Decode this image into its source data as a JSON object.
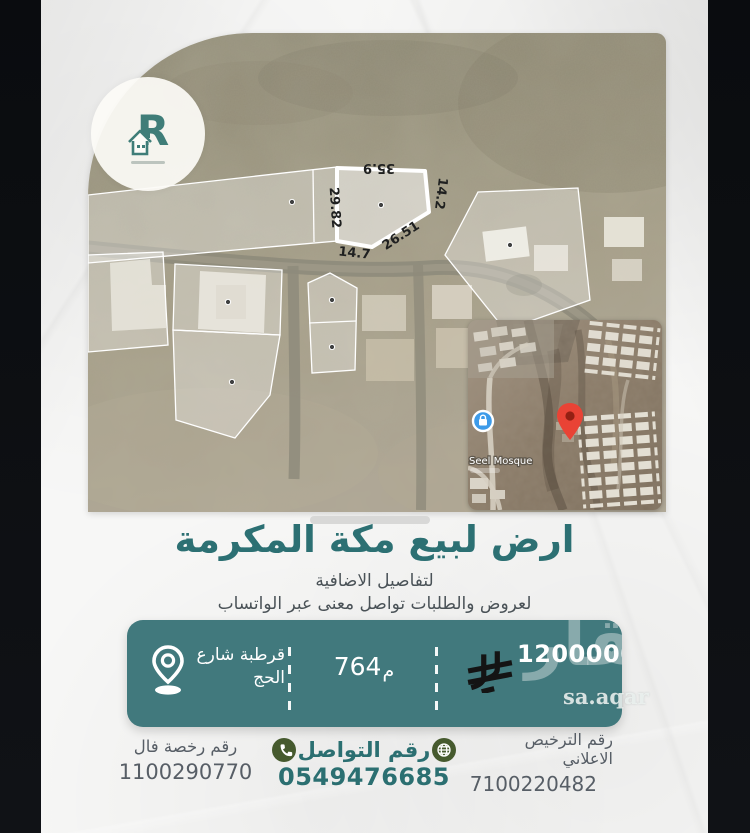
{
  "logo": {
    "letter": "R"
  },
  "map": {
    "measurements": {
      "top": "35.9",
      "right": "14.2",
      "left": "29.82",
      "diagonal": "26.51",
      "bottom": "14.7"
    }
  },
  "inset": {
    "mosque_label": "Seel Mosque"
  },
  "headline": {
    "title": "ارض لبيع مكة المكرمة",
    "details_line": "لتفاصيل الاضافية",
    "whatsapp_line": "لعروض والطلبات تواصل معنى عبر الواتساب"
  },
  "banner": {
    "price": "1200000",
    "area_value": "764",
    "area_unit": "م",
    "location_line1": "قرطبة شارع",
    "location_line2": "الحج"
  },
  "watermark": {
    "arabic": "عقار",
    "latin": "sa.aqar"
  },
  "footer": {
    "license_label_line1": "رقم الترخيص",
    "license_label_line2": "الاعلاني",
    "license_number": "7100220482",
    "contact_label": "رقم التواصل",
    "contact_number": "0549476685",
    "fal_label": "رقم رخصة فال",
    "fal_number": "1100290770"
  },
  "icons": {
    "logo": "house-r-logo",
    "location": "location-pin",
    "currency": "saudi-riyal-symbol",
    "contact_right": "globe",
    "contact_left": "phone",
    "inset_marker": "red-map-pin",
    "inset_poi": "blue-poi-badge"
  },
  "colors": {
    "banner_teal": "#41797d",
    "title_teal": "#2c7073",
    "icon_olive": "#465a2e",
    "pin_red": "#e94335",
    "poi_blue": "#3d9be9",
    "currency_black": "#141414",
    "paper": "#f7f7f6",
    "letterbox": "#0b0d10"
  }
}
